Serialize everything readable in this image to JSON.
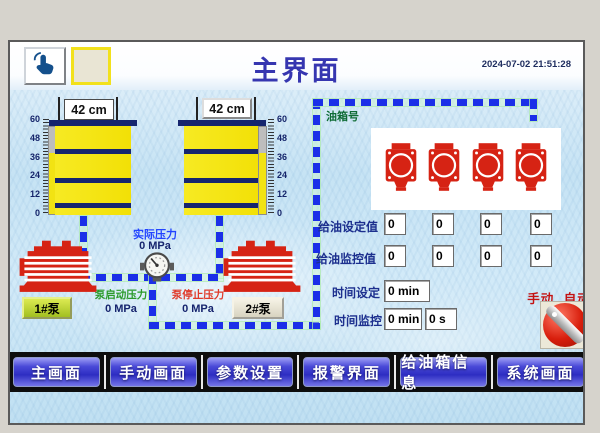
{
  "header": {
    "title": "主界面",
    "timestamp": "2024-07-02 21:51:28"
  },
  "scale": {
    "labels": [
      "60",
      "48",
      "36",
      "24",
      "12",
      "0"
    ]
  },
  "tanks": [
    {
      "level_display": "42 cm",
      "level_cm": 42,
      "capacity_cm": 60
    },
    {
      "level_display": "42 cm",
      "level_cm": 42,
      "capacity_cm": 60
    }
  ],
  "pressures": {
    "actual_label": "实际压力",
    "actual_value": "0 MPa",
    "start_label": "泵启动压力",
    "start_value": "0 MPa",
    "stop_label": "泵停止压力",
    "stop_value": "0 MPa"
  },
  "pumps": [
    {
      "label": "1#泵",
      "active": true
    },
    {
      "label": "2#泵",
      "active": false
    }
  ],
  "oil_panel": {
    "title": "油箱号",
    "station_count": 4,
    "set_row": {
      "label": "给油设定值",
      "values": [
        "0",
        "0",
        "0",
        "0"
      ]
    },
    "monitor_row": {
      "label": "给油监控值",
      "values": [
        "0",
        "0",
        "0",
        "0"
      ]
    },
    "time_set": {
      "label": "时间设定",
      "value": "0 min"
    },
    "time_monitor": {
      "label": "时间监控",
      "minutes": "0 min",
      "seconds": "0 s"
    },
    "mode": {
      "manual": "手动",
      "auto": "自动"
    }
  },
  "nav": {
    "items": [
      "主画面",
      "手动画面",
      "参数设置",
      "报警界面",
      "给油箱信息",
      "系统画面"
    ]
  },
  "colors": {
    "pipe_blue": "#1b2fe8",
    "title_blue": "#3636b0",
    "barrel_yellow": "#f2e313",
    "band_navy": "#16256e",
    "device_red": "#d62314",
    "actual_blue": "#2244ff",
    "start_green": "#2a9a2a",
    "stop_red": "#e03a2a",
    "tankno_green": "#0e6b35",
    "mode_red": "#c41212"
  }
}
